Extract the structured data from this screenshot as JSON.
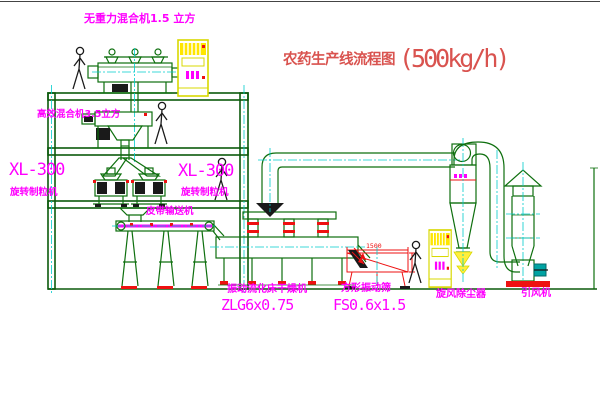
{
  "title": {
    "text": "农药生产线流程图",
    "capacity": "(500kg/h)"
  },
  "labels": {
    "top_mixer": "无重力混合机1.5 立方",
    "high_eff_mixer": "高效混合机3.5立方",
    "granulator_left_model": "XL-300",
    "granulator_left_name": "旋转制粒机",
    "granulator_mid_model": "XL-300",
    "granulator_mid_name": "旋转制粒机",
    "belt_conveyor": "皮带输送机",
    "dryer_name": "振动流化床干燥机",
    "dryer_model": "ZLG6x0.75",
    "screen_name": "方形振动筛",
    "screen_model": "FS0.6x1.5",
    "cyclone_name": "旋风除尘器",
    "fan_name": "引风机",
    "screen_dim_width": "1500"
  },
  "colors": {
    "magenta": "#ff00ff",
    "titlered": "#d9534f",
    "green": "#0e6f0e",
    "cyan": "#00cccc",
    "red": "#ee1111",
    "yellow": "#ffee00",
    "teal": "#00a3a3"
  }
}
